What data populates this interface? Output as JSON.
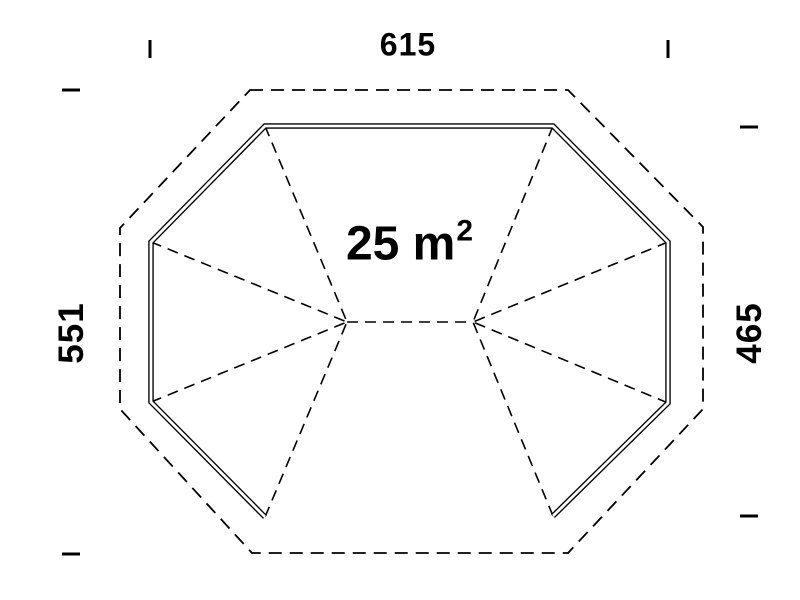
{
  "title": "Gazebo floor plan drawing",
  "area_label": {
    "text": "25 m",
    "superscript": "2"
  },
  "dimensions": {
    "top": "615",
    "left": "551",
    "right": "465"
  },
  "colors": {
    "ink": "#000000",
    "background": "#ffffff"
  },
  "plan": {
    "outer_outline": {
      "points": [
        [
          250,
          90
        ],
        [
          568,
          90
        ],
        [
          703,
          227
        ],
        [
          703,
          409
        ],
        [
          568,
          553
        ],
        [
          252,
          553
        ],
        [
          120,
          409
        ],
        [
          120,
          228
        ]
      ],
      "dash": "13 8",
      "width": 1.8
    },
    "walls": {
      "points": [
        [
          265,
          517
        ],
        [
          151,
          402
        ],
        [
          151,
          242
        ],
        [
          265,
          126
        ],
        [
          553,
          126
        ],
        [
          668,
          242
        ],
        [
          668,
          403
        ],
        [
          553,
          516
        ]
      ],
      "outer_width": 5.5,
      "inner_width": 2.8
    },
    "hip_lines": [
      [
        265,
        126,
        347,
        322
      ],
      [
        151,
        242,
        347,
        322
      ],
      [
        151,
        402,
        347,
        322
      ],
      [
        265,
        517,
        347,
        322
      ],
      [
        553,
        126,
        473,
        322
      ],
      [
        668,
        242,
        473,
        322
      ],
      [
        668,
        403,
        473,
        322
      ],
      [
        553,
        516,
        473,
        322
      ]
    ],
    "ridge": [
      347,
      322,
      473,
      322
    ],
    "line_style": {
      "hip_width": 1.6,
      "hip_dash": "11 7"
    },
    "ticks": [
      {
        "name": "top-left",
        "x1": 150,
        "y1": 40,
        "x2": 150,
        "y2": 58
      },
      {
        "name": "top-right",
        "x1": 668,
        "y1": 40,
        "x2": 668,
        "y2": 58
      },
      {
        "name": "left-top",
        "x1": 62,
        "y1": 90,
        "x2": 80,
        "y2": 90
      },
      {
        "name": "left-bottom",
        "x1": 62,
        "y1": 554,
        "x2": 80,
        "y2": 554
      },
      {
        "name": "right-top",
        "x1": 740,
        "y1": 127,
        "x2": 758,
        "y2": 127
      },
      {
        "name": "right-bottom",
        "x1": 740,
        "y1": 516,
        "x2": 758,
        "y2": 516
      }
    ],
    "tick_width": 3
  },
  "label_positions": {
    "top": {
      "x": 408,
      "y": 45
    },
    "left": {
      "x": 72,
      "y": 333
    },
    "right": {
      "x": 750,
      "y": 333
    },
    "area": {
      "x": 409,
      "y": 244
    }
  }
}
